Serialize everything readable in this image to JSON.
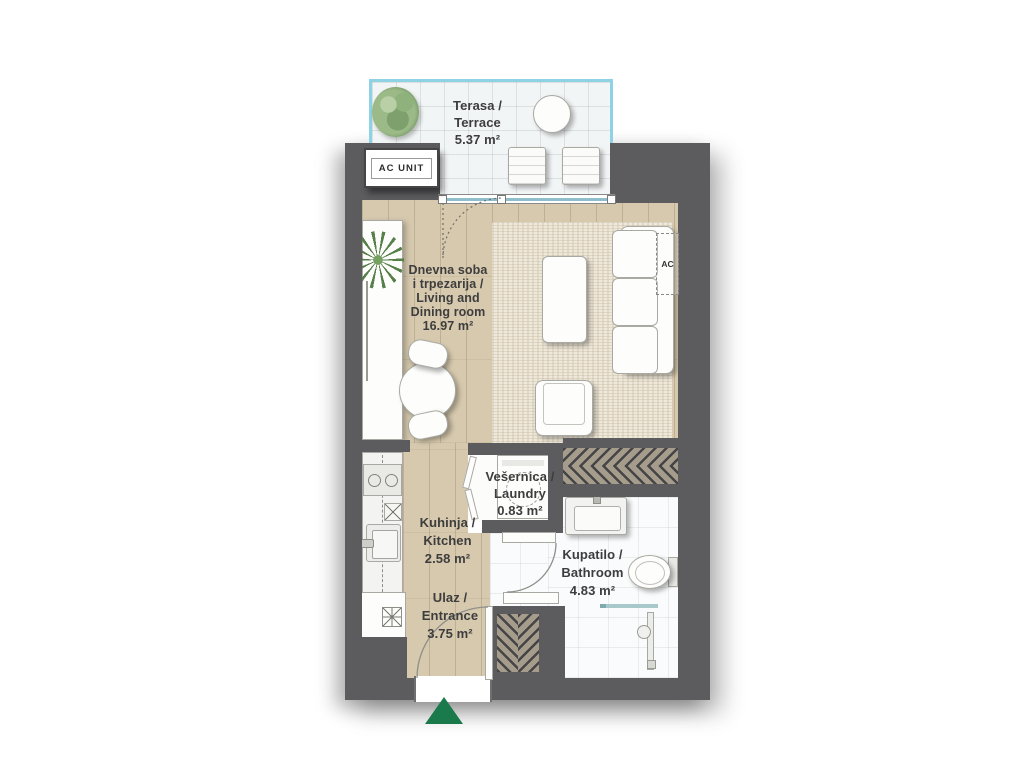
{
  "rooms": {
    "terrace": {
      "line1": "Terasa /",
      "line2": "Terrace",
      "area": "5.37 m²"
    },
    "living": {
      "line1": "Dnevna soba",
      "line2": "i trpezarija /",
      "line3": "Living and",
      "line4": "Dining room",
      "area": "16.97 m²"
    },
    "kitchen": {
      "line1": "Kuhinja /",
      "line2": "Kitchen",
      "area": "2.58 m²"
    },
    "laundry": {
      "line1": "Vešernica /",
      "line2": "Laundry",
      "area": "0.83 m²"
    },
    "bathroom": {
      "line1": "Kupatilo /",
      "line2": "Bathroom",
      "area": "4.83 m²"
    },
    "entrance": {
      "line1": "Ulaz /",
      "line2": "Entrance",
      "area": "3.75 m²"
    }
  },
  "annotations": {
    "ac_unit": "AC UNIT",
    "ac_indoor": "AC"
  },
  "colors": {
    "wall": "#5c5b5e",
    "terrace_rail": "#8ed2e4",
    "entrance_marker_green": "#1b7a4b",
    "wood_floor": "#d6c9ae",
    "rug": "#efe9dc",
    "tile": "#fafbfc"
  }
}
